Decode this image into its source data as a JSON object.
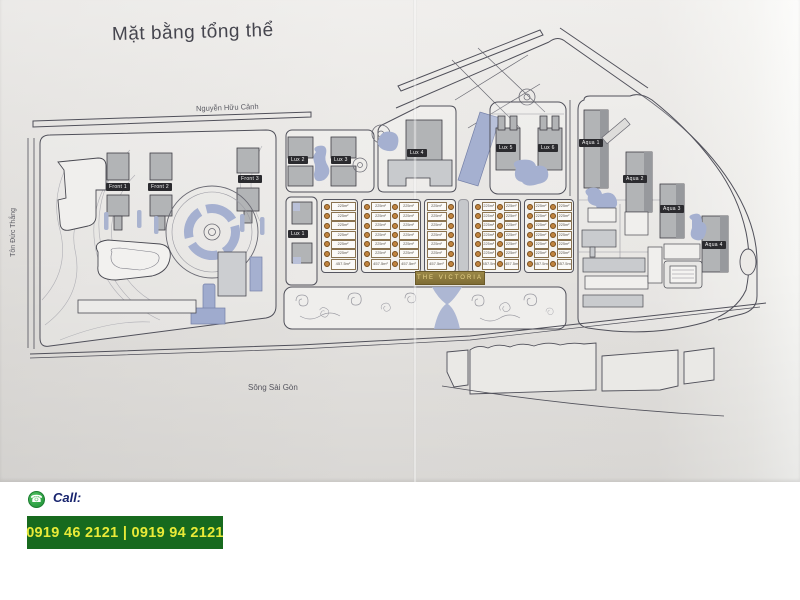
{
  "title": "Mặt bằng tổng thể",
  "streets": {
    "top": "Nguyễn Hữu Cảnh",
    "left": "Tôn Đức Thắng",
    "river": "Sông Sài Gòn"
  },
  "buildings": {
    "front": [
      "Front 1",
      "Front 2",
      "Front 3"
    ],
    "lux": [
      "Lux 1",
      "Lux 2",
      "Lux 3",
      "Lux 4",
      "Lux 5",
      "Lux 6"
    ],
    "aqua": [
      "Aqua 1",
      "Aqua 2",
      "Aqua 3",
      "Aqua 4"
    ]
  },
  "victoria": {
    "banner": "THE VICTORIA",
    "lot_area_label": "225m²",
    "corner_lot_area_label": "457.5m²",
    "rows_per_cluster": 6,
    "clusters": [
      {
        "columns": 1,
        "circles": "left"
      },
      {
        "columns": 2,
        "circles": "left"
      },
      {
        "columns": 1,
        "circles": "right"
      },
      {
        "columns": 2,
        "circles": "left"
      },
      {
        "columns": 2,
        "circles": "left"
      }
    ]
  },
  "contact": {
    "call_label": "Call:",
    "phones": "0919 46 2121 | 0919 94 2121"
  },
  "colors": {
    "paper": "#e9e7e4",
    "line": "#50505a",
    "building": "#b2b4b6",
    "water": "#a5b0d0",
    "label_bg": "#2b2b2f",
    "victoria_gold": "#8f7d42",
    "marker": "#c08440",
    "call_green": "#176a1e",
    "phone_text": "#e9ea38"
  }
}
